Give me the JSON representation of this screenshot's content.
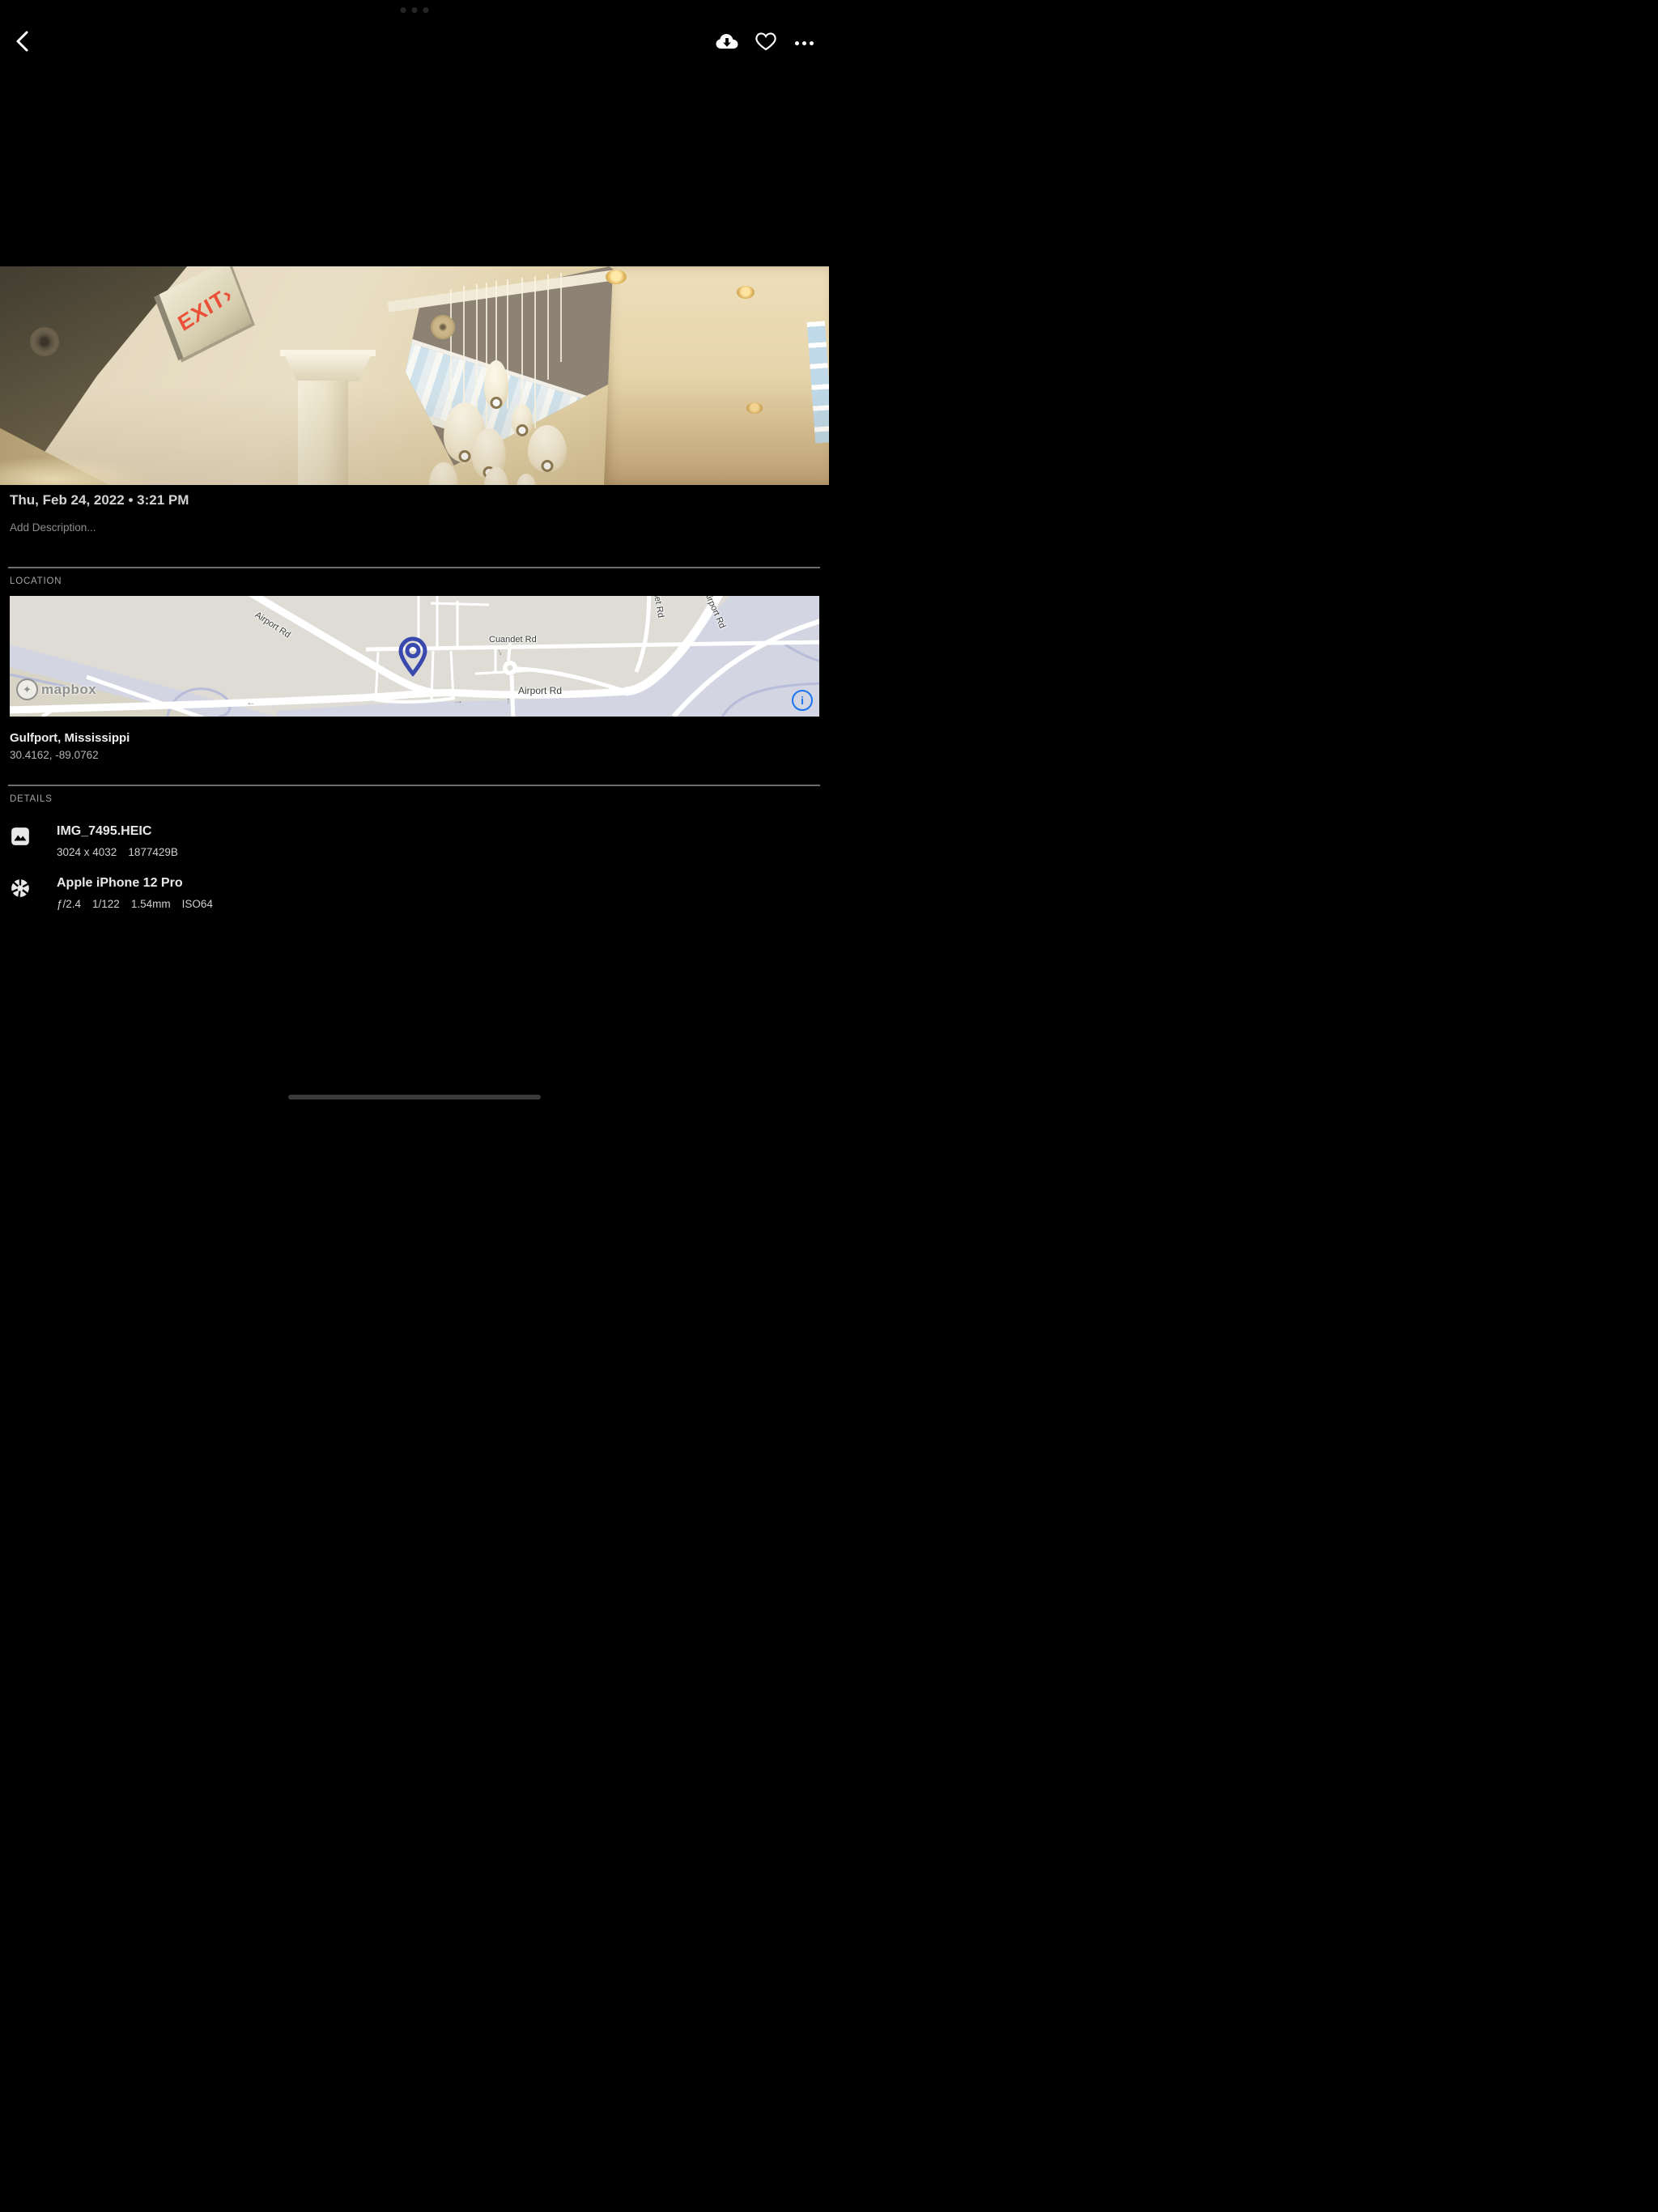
{
  "top_bar": {
    "back_icon": "chevron-left",
    "download_icon": "cloud-download",
    "favorite_icon": "heart-outline",
    "more_icon": "ellipsis-horizontal"
  },
  "photo": {
    "exit_sign_text": "EXIT›"
  },
  "info": {
    "datetime": "Thu, Feb 24, 2022 • 3:21 PM",
    "description_placeholder": "Add Description..."
  },
  "location": {
    "header": "LOCATION",
    "place": "Gulfport, Mississippi",
    "coordinates": "30.4162, -89.0762",
    "map": {
      "labels": [
        "Airport Rd",
        "Cuandet Rd",
        "Airport Rd",
        "Airport Rd",
        "Cuandet Rd"
      ],
      "attribution": "mapbox",
      "info_icon": "i"
    }
  },
  "details": {
    "header": "DETAILS",
    "file": {
      "icon": "image",
      "name": "IMG_7495.HEIC",
      "meta": [
        "3024 x 4032",
        "1877429B"
      ]
    },
    "camera": {
      "icon": "aperture",
      "name": "Apple iPhone 12 Pro",
      "meta": [
        "ƒ/2.4",
        "1/122",
        "1.54mm",
        "ISO64"
      ]
    }
  }
}
